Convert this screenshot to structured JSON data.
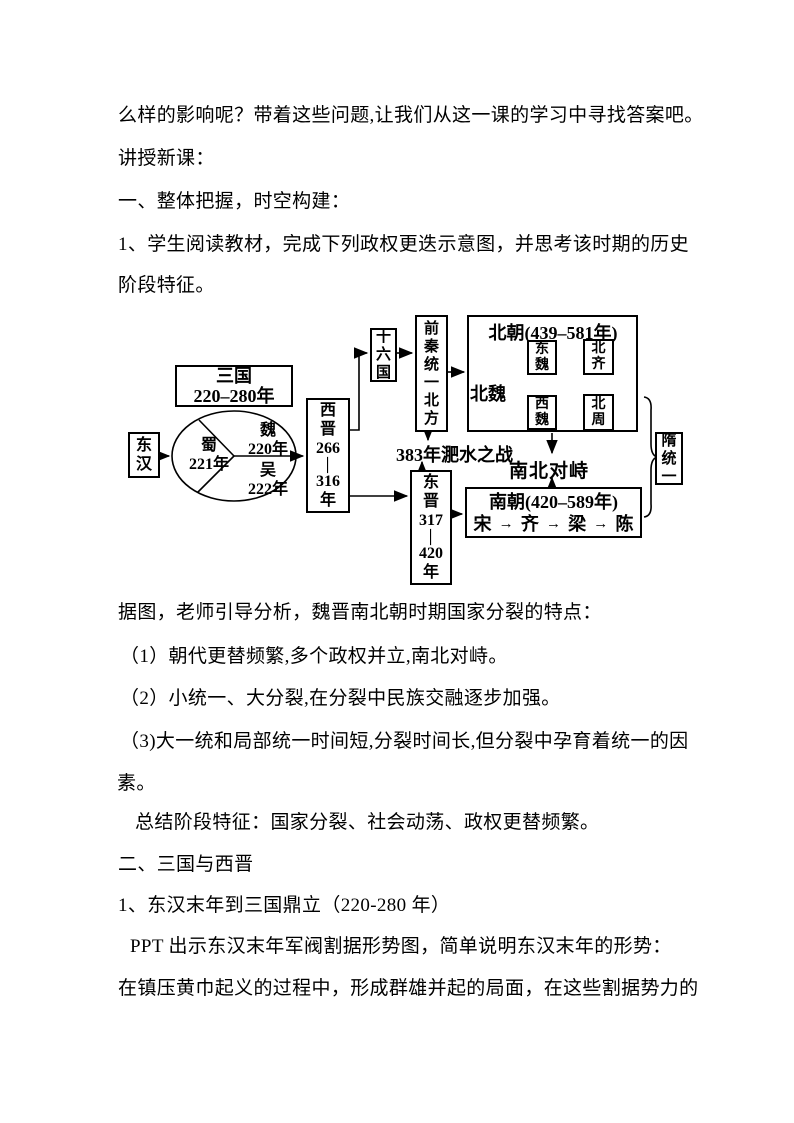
{
  "doc": {
    "lines": [
      "么样的影响呢？带着这些问题,让我们从这一课的学习中寻找答案吧。",
      "讲授新课：",
      "一、整体把握，时空构建：",
      "1、学生阅读教材，完成下列政权更迭示意图，并思考该时期的历史",
      "阶段特征。",
      "据图，老师引导分析，魏晋南北朝时期国家分裂的特点：",
      "（1）朝代更替频繁,多个政权并立,南北对峙。",
      "（2）小统一、大分裂,在分裂中民族交融逐步加强。",
      "（3)大一统和局部统一时间短,分裂时间长,但分裂中孕育着统一的因",
      "素。",
      "总结阶段特征：国家分裂、社会动荡、政权更替频繁。",
      "二、三国与西晋",
      "1、东汉末年到三国鼎立（220-280 年）",
      "PPT 出示东汉末年军阀割据形势图，简单说明东汉末年的形势：",
      "在镇压黄巾起义的过程中，形成群雄并起的局面，在这些割据势力的"
    ]
  },
  "diagram": {
    "donghan": {
      "segments": [
        "东",
        "汉"
      ]
    },
    "sanguo": {
      "line1": "三国",
      "line2": "220–280年"
    },
    "pie": {
      "shu_name": "蜀",
      "shu_year": "221年",
      "wei_name": "魏",
      "wei_year": "220年",
      "wu_name": "吴",
      "wu_year": "222年"
    },
    "xijin": {
      "segments": [
        "西",
        "晋",
        "266",
        "—",
        "316",
        "年"
      ]
    },
    "shiliuguo": {
      "segments": [
        "十",
        "六",
        "国"
      ]
    },
    "qianqin": {
      "segments": [
        "前",
        "秦",
        "统",
        "一",
        "北",
        "方"
      ]
    },
    "beichao": {
      "title": "北朝(439–581年)",
      "label": "北魏",
      "dongwei": {
        "segments": [
          "东",
          "魏"
        ]
      },
      "beiqi": {
        "segments": [
          "北",
          "齐"
        ]
      },
      "xiwei": {
        "segments": [
          "西",
          "魏"
        ]
      },
      "beizhou": {
        "segments": [
          "北",
          "周"
        ]
      }
    },
    "feishui": "383年淝水之战",
    "duizhi": "南北对峙",
    "dongjin": {
      "segments": [
        "东",
        "晋",
        "317",
        "—",
        "420",
        "年"
      ]
    },
    "nanchao": {
      "title": "南朝(420–589年)",
      "sequence": [
        "宋",
        "齐",
        "梁",
        "陈"
      ]
    },
    "sui": {
      "segments": [
        "隋",
        "统",
        "一"
      ]
    },
    "colors": {
      "line": "#000000",
      "qi_zhou_arrow": "#555555"
    }
  }
}
